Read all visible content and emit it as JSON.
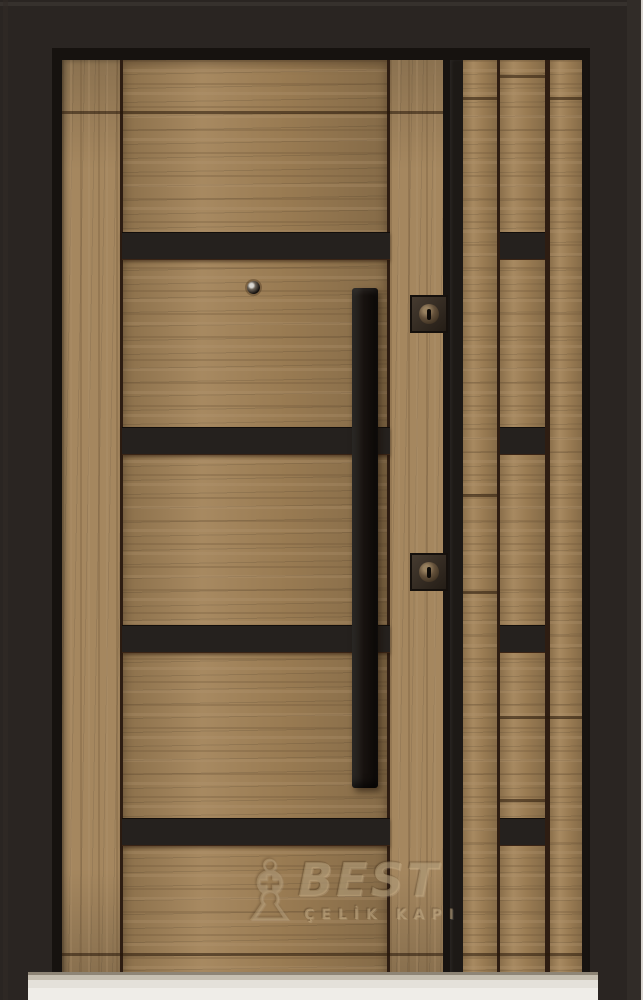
{
  "image": {
    "description": "Product photograph of a wood-finish steel entry door with a narrow right sidelite panel, black horizontal accent stripes, a long vertical black pull handle, two lock cylinders, a peephole and a brand watermark.",
    "width_px": 643,
    "height_px": 1000
  },
  "watermark": {
    "icon": "chess-bishop-icon",
    "brand": "BEST",
    "subtitle": "ÇELİK KAPI"
  },
  "hardware": {
    "locks_count": 2,
    "leaf_accent_stripes": 4,
    "sidelite_accent_blocks": 4,
    "handle": "vertical pull bar",
    "peephole": 1
  },
  "colors": {
    "frame": "#2a2522",
    "frame_seam": "#16120f",
    "wood": "#a28257",
    "accent_black": "#25211e",
    "stripe_black": "#1d1916",
    "sill": "#e4e1da",
    "watermark_text": "#ccb48a"
  }
}
